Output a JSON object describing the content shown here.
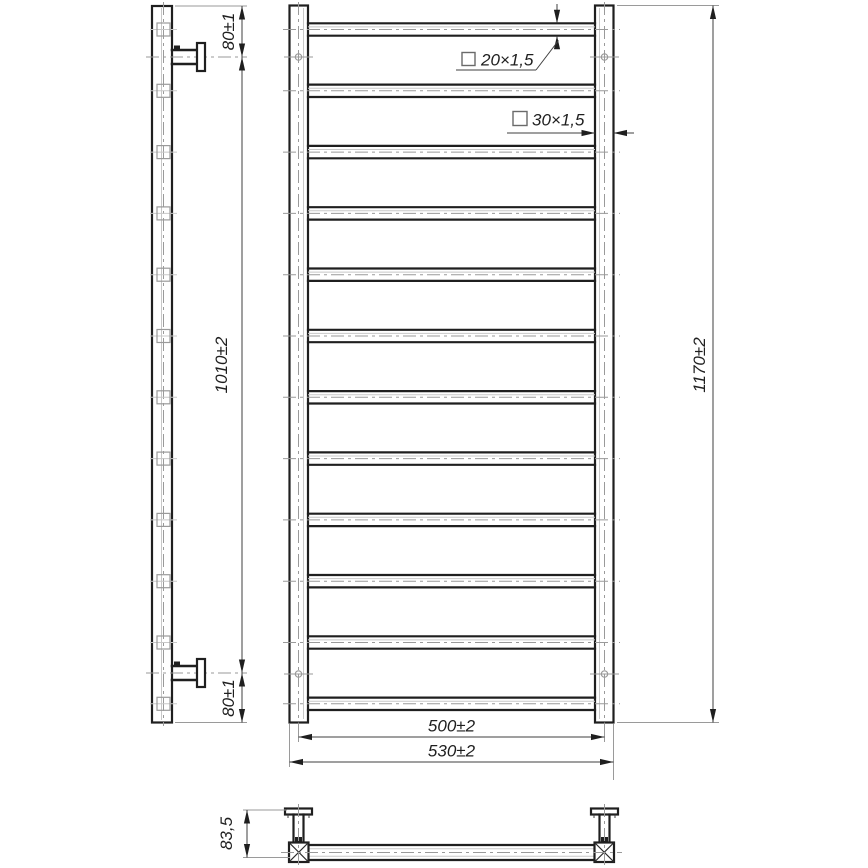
{
  "drawing": {
    "type": "technical-drawing",
    "description": "Ladder towel rail - side view, front view and top view with dimensions",
    "background": "#ffffff",
    "rung_count": 12,
    "line_colors": {
      "outline": "#1f1f1f",
      "dimension": "#3f3f3f",
      "extension": "#9a9a9a",
      "centerline": "#9a9a9a",
      "thin_edge": "#c8c8c8"
    },
    "dimensions": {
      "top_bracket_offset": "80±1",
      "bracket_spacing": "1010±2",
      "bottom_bracket_offset": "80±1",
      "rung_tube_spec": "20×1,5",
      "post_tube_spec": "30×1,5",
      "overall_height": "1170±2",
      "rung_center_width": "500±2",
      "overall_width": "530±2",
      "mounting_depth": "83,5"
    }
  }
}
